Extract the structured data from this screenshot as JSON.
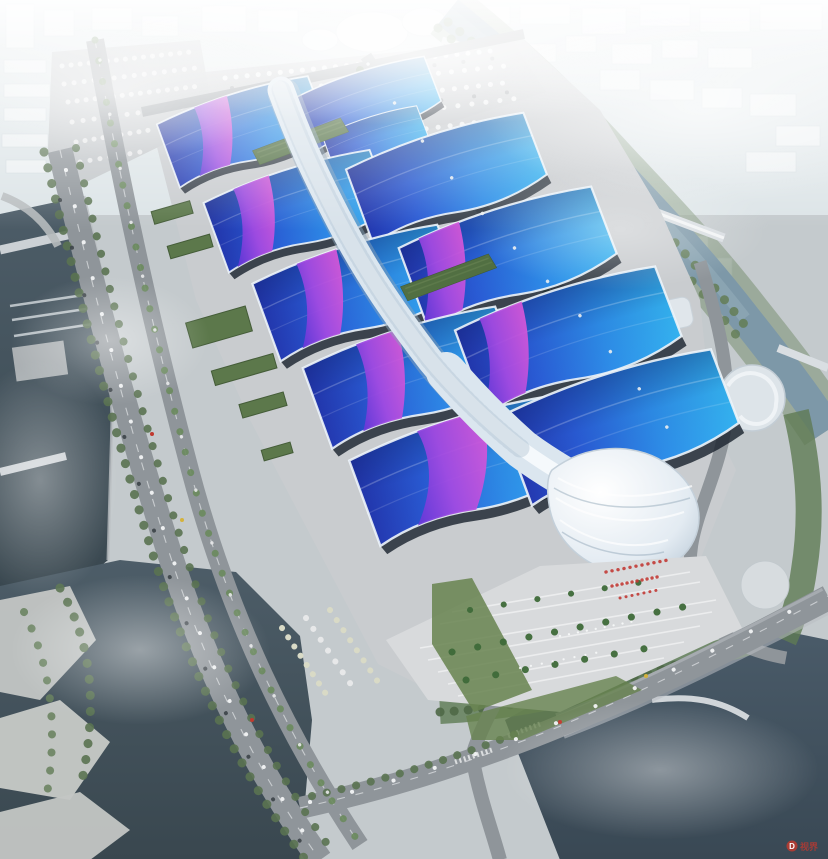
{
  "scene": {
    "type": "aerial architectural rendering",
    "subject": "riverside exhibition and convention center complex",
    "description": "Bird's-eye rendering of paired exhibition halls with wavy blue roofs swept by purple ribbons, joined along a white serpentine central canopy that ends in a shell-shaped entrance hall; around the site are an arrival plaza with palm trees and a red-flag crowd, truck and bus parking lots, tree-lined expressways, a dark river with locks on the left, a canal with bridges on the right, lakes at the bottom and a foggy white city skyline at the top"
  },
  "watermark": {
    "logo_letter": "D",
    "text": "视界"
  },
  "palette": {
    "roof_blue_dark": "#2336ae",
    "roof_blue": "#2a5cd6",
    "roof_cyan": "#35b5f2",
    "ribbon_violet": "#5633d6",
    "ribbon_purple": "#a54ae2",
    "ribbon_magenta": "#d657d8",
    "spine_white": "#f7fafc",
    "pavement": "#c9cccf",
    "plaza": "#d8dadc",
    "road": "#8f959a",
    "green_roof": "#516f42",
    "tree_green": "#5a7351",
    "water_dark": "#42525e",
    "canal_blue": "#7d98a8",
    "haze_white": "#f4f7f9",
    "crowd_red": "#c23b36"
  }
}
